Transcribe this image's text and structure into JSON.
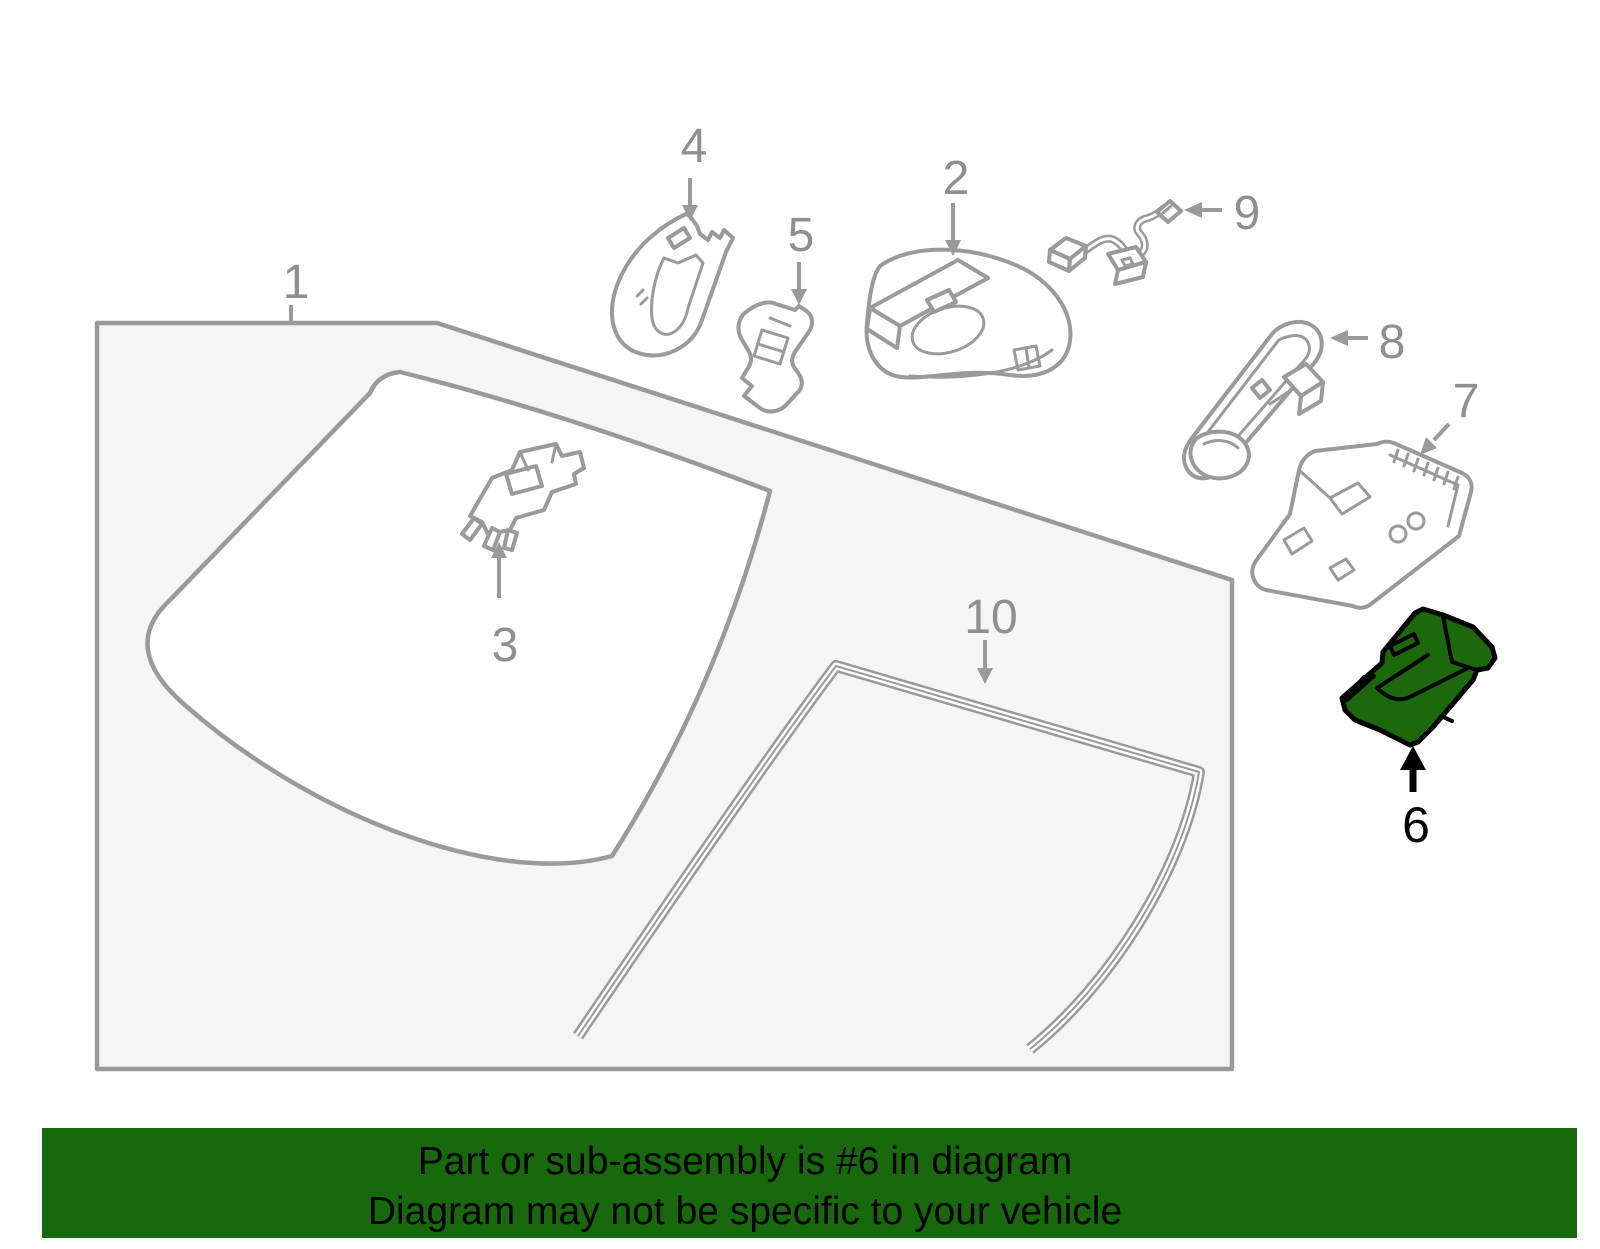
{
  "page": {
    "kind": "auto-parts-catalog-diagram",
    "background": "#FFFFFF"
  },
  "banner": {
    "line1": "Part or sub-assembly is #6 in diagram",
    "line2": "Diagram may not be specific to your vehicle",
    "bg_color": "#17690B",
    "text_color": "#000000"
  },
  "highlighted_callout": "6",
  "callouts": [
    {
      "number": "1",
      "highlighted": false
    },
    {
      "number": "2",
      "highlighted": false
    },
    {
      "number": "3",
      "highlighted": false
    },
    {
      "number": "4",
      "highlighted": false
    },
    {
      "number": "5",
      "highlighted": false
    },
    {
      "number": "6",
      "highlighted": true
    },
    {
      "number": "7",
      "highlighted": false
    },
    {
      "number": "8",
      "highlighted": false
    },
    {
      "number": "9",
      "highlighted": false
    },
    {
      "number": "10",
      "highlighted": false
    }
  ],
  "colors": {
    "line_gray": "#9A9A9A",
    "label_gray": "#8F8F8F",
    "panel_fill": "#F5F5F6",
    "highlight_green": "#1B690A",
    "highlight_outline": "#000000",
    "background": "#FFFFFF"
  }
}
